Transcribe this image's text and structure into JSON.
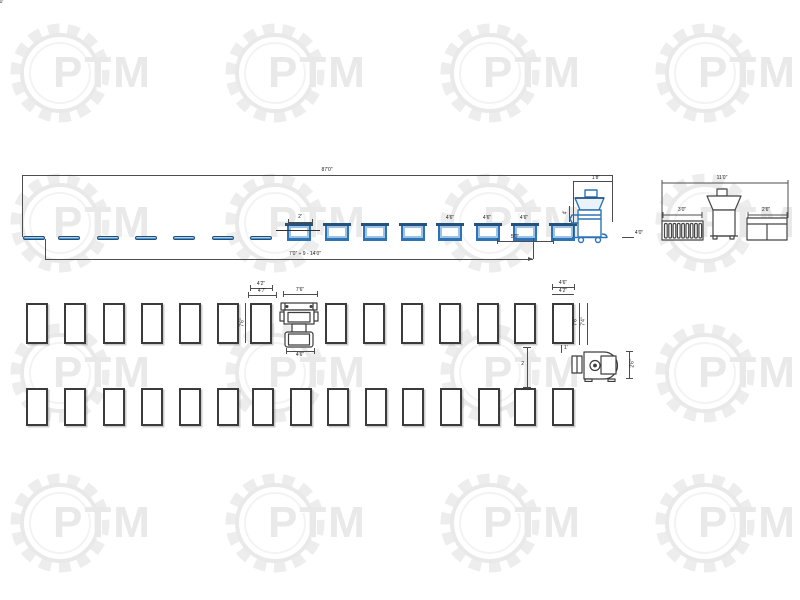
{
  "watermark": {
    "text": "PTM",
    "color": "#e9e9e9",
    "positions": [
      {
        "x": 5,
        "y": 18
      },
      {
        "x": 220,
        "y": 18
      },
      {
        "x": 435,
        "y": 18
      },
      {
        "x": 650,
        "y": 18
      },
      {
        "x": 5,
        "y": 168
      },
      {
        "x": 220,
        "y": 168
      },
      {
        "x": 435,
        "y": 168
      },
      {
        "x": 650,
        "y": 168
      },
      {
        "x": 5,
        "y": 318
      },
      {
        "x": 220,
        "y": 318
      },
      {
        "x": 435,
        "y": 318
      },
      {
        "x": 650,
        "y": 318
      },
      {
        "x": 5,
        "y": 468
      },
      {
        "x": 220,
        "y": 468
      },
      {
        "x": 435,
        "y": 468
      },
      {
        "x": 650,
        "y": 468
      }
    ]
  },
  "top_view": {
    "dim_total_top": "87'0\"",
    "dim_total_bottom": "7'0\" ÷ 9 - 14'0\"",
    "dim_first_tub": "2'",
    "tub_dim_labels": [
      {
        "x": 450,
        "y": 216,
        "label": "4'6\""
      },
      {
        "x": 487,
        "y": 216,
        "label": "4'6\""
      },
      {
        "x": 524,
        "y": 216,
        "label": "4'6\""
      }
    ],
    "dim_seg_left": "5'0\"",
    "dim_seg_right": "4'0\"",
    "machine_dim_top": "1'8\"",
    "machine_dim_side": "4'",
    "machine_dim_right": "4'0\"",
    "table_bars": [
      {
        "x": 23,
        "y": 236
      },
      {
        "x": 58,
        "y": 236
      },
      {
        "x": 97,
        "y": 236
      },
      {
        "x": 135,
        "y": 236
      },
      {
        "x": 173,
        "y": 236
      },
      {
        "x": 212,
        "y": 236
      },
      {
        "x": 250,
        "y": 236
      }
    ],
    "tubs": [
      {
        "x": 287,
        "y": 224
      },
      {
        "x": 325,
        "y": 224
      },
      {
        "x": 363,
        "y": 224
      },
      {
        "x": 401,
        "y": 224
      },
      {
        "x": 438,
        "y": 224
      },
      {
        "x": 476,
        "y": 224
      },
      {
        "x": 513,
        "y": 224
      },
      {
        "x": 551,
        "y": 224
      }
    ]
  },
  "end_view": {
    "dim_total": "11'0\"",
    "dim_left_unit": "3'0\"",
    "dim_right_unit": "2'6\""
  },
  "plan_view": {
    "ref_table_dims": {
      "top_inner": "4'2\"",
      "top_outer": "4'7\"",
      "side": "7'6\""
    },
    "machine_dims": {
      "top": "7'6\"",
      "bottom": "4'6\""
    },
    "last_table_dims": {
      "top_inner": "4'6\"",
      "top_outer": "4'2\"",
      "side_inner": "7'6\"",
      "side_outer": "7'4\"",
      "below": "1'"
    },
    "row_gap_dim": "2",
    "grinder_dim_side": "2'6\"",
    "row1": [
      {
        "x": 26,
        "y": 303
      },
      {
        "x": 64,
        "y": 303
      },
      {
        "x": 103,
        "y": 303
      },
      {
        "x": 141,
        "y": 303
      },
      {
        "x": 179,
        "y": 303
      },
      {
        "x": 217,
        "y": 303
      },
      {
        "x": 250,
        "y": 303
      },
      {
        "x": 325,
        "y": 303
      },
      {
        "x": 363,
        "y": 303
      },
      {
        "x": 401,
        "y": 303
      },
      {
        "x": 439,
        "y": 303
      },
      {
        "x": 477,
        "y": 303
      },
      {
        "x": 514,
        "y": 303
      },
      {
        "x": 552,
        "y": 303
      }
    ],
    "row2": [
      {
        "x": 26,
        "y": 388
      },
      {
        "x": 64,
        "y": 388
      },
      {
        "x": 103,
        "y": 388
      },
      {
        "x": 141,
        "y": 388
      },
      {
        "x": 179,
        "y": 388
      },
      {
        "x": 217,
        "y": 388
      },
      {
        "x": 252,
        "y": 388
      },
      {
        "x": 290,
        "y": 388
      },
      {
        "x": 327,
        "y": 388
      },
      {
        "x": 365,
        "y": 388
      },
      {
        "x": 402,
        "y": 388
      },
      {
        "x": 440,
        "y": 388
      },
      {
        "x": 478,
        "y": 388
      },
      {
        "x": 514,
        "y": 388
      },
      {
        "x": 552,
        "y": 388
      }
    ]
  }
}
